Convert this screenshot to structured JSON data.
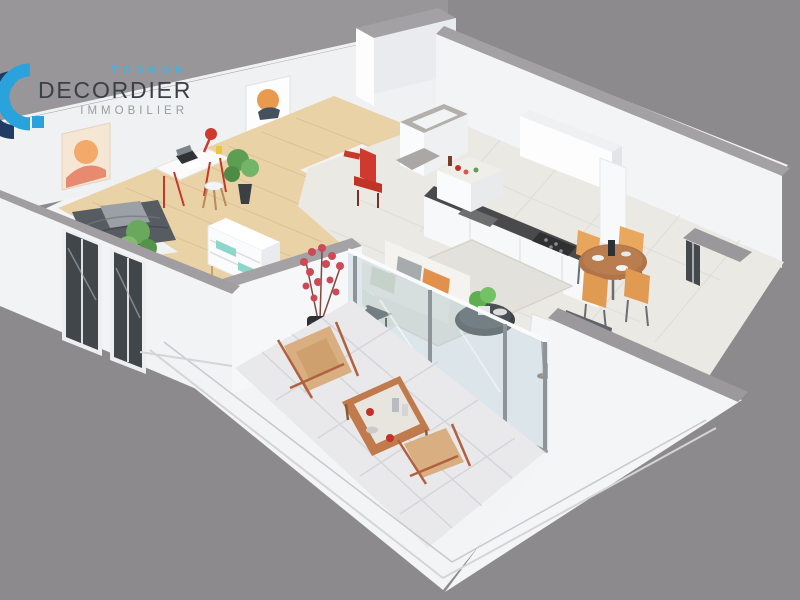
{
  "page": {
    "type": "3d-floor-plan-render",
    "description": "Isometric 3D dollhouse floor plan of a one-bedroom apartment with balcony on a plain gray background, watermarked with the DECORDIER Immobilier agency logo in the top-left corner."
  },
  "logo": {
    "city": "THONON",
    "name": "DECORDIER",
    "tagline": "IMMOBILIER",
    "icon": "stylized-letter-C-with-square-dot",
    "colors": {
      "city_text": "#41b2e2",
      "name_text": "#3a4046",
      "tagline_text": "#9b9b9b",
      "icon_blue": "#2aa3dc",
      "icon_navy": "#1f3b63"
    }
  },
  "scene": {
    "palette": {
      "background": "#8c8a8c",
      "slab_white": "#f3f4f5",
      "wall_face": "#eff1f3",
      "wall_cap_gray": "#a3a1a3",
      "concrete_gray": "#b3b0ac",
      "bedroom_wood_floor": "#ead2a7",
      "living_tile_floor": "#ebe9e4",
      "balcony_tile_floor": "#e9e9eb",
      "counter_top_dark": "#4a4a4c",
      "accent_orange": "#e8a55c",
      "accent_red": "#ce3d36",
      "plant_green": "#6aa85e",
      "bed_gray": "#575c62",
      "glass_blue": "#b9cdd6"
    },
    "rooms": [
      {
        "name": "bedroom",
        "floor": "wood",
        "items": [
          "double-bed",
          "desk",
          "red-desk-lamp",
          "laptop",
          "stool",
          "white-dresser-teal-accents",
          "potted-plants",
          "wall-art"
        ]
      },
      {
        "name": "entry-hall",
        "floor": "tile",
        "items": [
          "red-chair",
          "red-wall-shelf"
        ]
      },
      {
        "name": "bathroom",
        "items": [
          "walk-in-shower-concrete-walls"
        ]
      },
      {
        "name": "kitchen",
        "floor": "tile",
        "items": [
          "white-wall-cabinet",
          "counter-with-sink",
          "cooktop",
          "island-counter-with-groceries",
          "tall-cabinet-column"
        ]
      },
      {
        "name": "dining-area",
        "floor": "tile",
        "items": [
          "round-wood-table",
          "orange-chair-1",
          "orange-chair-2",
          "orange-chair-3",
          "orange-chair-4"
        ]
      },
      {
        "name": "living-room",
        "floor": "tile",
        "items": [
          "white-sofa-orange-cushions",
          "round-coffee-table-with-plant",
          "dark-side-table",
          "rug",
          "floor-lamp",
          "gray-armchair-red-cushion",
          "tall-black-vase-red-flowers",
          "glass-sliding-doors"
        ]
      },
      {
        "name": "balcony",
        "floor": "tile",
        "items": [
          "deck-chair-1",
          "deck-chair-2",
          "wooden-coffee-table",
          "white-railing"
        ]
      }
    ]
  }
}
